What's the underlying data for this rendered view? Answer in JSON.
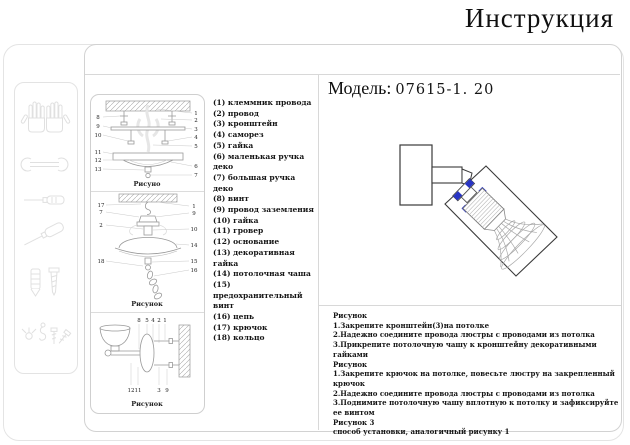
{
  "title": "Инструкция",
  "model": {
    "label": "Модель:",
    "number": "07615-1. 20"
  },
  "parts": {
    "items": [
      "(1) клеммник провода",
      "(2) провод",
      "(3) кронштейн",
      "(4) саморез",
      "(5) гайка",
      "(6) маленькая ручка деко",
      "(7) большая ручка деко",
      "(8) винт",
      "(9) провод заземления",
      "(10) гайка",
      "(11) гровер",
      "(12) основание",
      "(13) декоративная гайка",
      "(14) потолочная чаша",
      "(15) предохранительный винт",
      "(16) цепь",
      "(17) крючок",
      "(18) кольцо"
    ]
  },
  "figures": {
    "fig1": {
      "caption": "Рисуно",
      "left_labels": [
        "8",
        "9",
        "10",
        "11",
        "12",
        "13"
      ],
      "right_labels": [
        "1",
        "2",
        "3",
        "4",
        "5",
        "6",
        "7"
      ]
    },
    "fig2": {
      "caption": "Рисунок",
      "left_labels": [
        "17",
        "7",
        "2",
        "18"
      ],
      "right_labels": [
        "1",
        "9",
        "10",
        "14",
        "15",
        "16"
      ]
    },
    "fig3": {
      "caption": "Рисунок",
      "top_labels": [
        "8",
        "5",
        "4",
        "2",
        "1"
      ],
      "bottom_labels": [
        "12",
        "11",
        "3",
        "9"
      ]
    }
  },
  "instructions": {
    "lines": [
      "Рисунок",
      "1.Закрепите кронштейн(3)на потолке",
      "2.Надежно соедините провода люстры с проводами из потолка",
      "3.Прикрепите потолочную чашу к кронштейну декоративными гайками",
      "Рисунок",
      "1.Закрепите крючок на потолке, повесьте люстру на закрепленный крючок",
      "2.Надежно соедините провода люстры с проводами из потолка",
      "3.Поднимите потолочную чашу вплотную к потолку и зафиксируйте ее винтом",
      "Рисунок 3",
      "способ установки,  аналогичный рисунку 1"
    ]
  },
  "tools": {
    "icons": [
      "gloves-icon",
      "wrench-icon",
      "screwdriver-icon",
      "long-screwdriver-icon",
      "dowel-and-screw-icon",
      "hardware-parts-icon"
    ]
  },
  "colors": {
    "accent_blue": "#2834c4",
    "border_light": "#e0e0e0",
    "divider": "#d8d8d8",
    "diagram_line": "#999999",
    "text": "#1a1a1a"
  }
}
